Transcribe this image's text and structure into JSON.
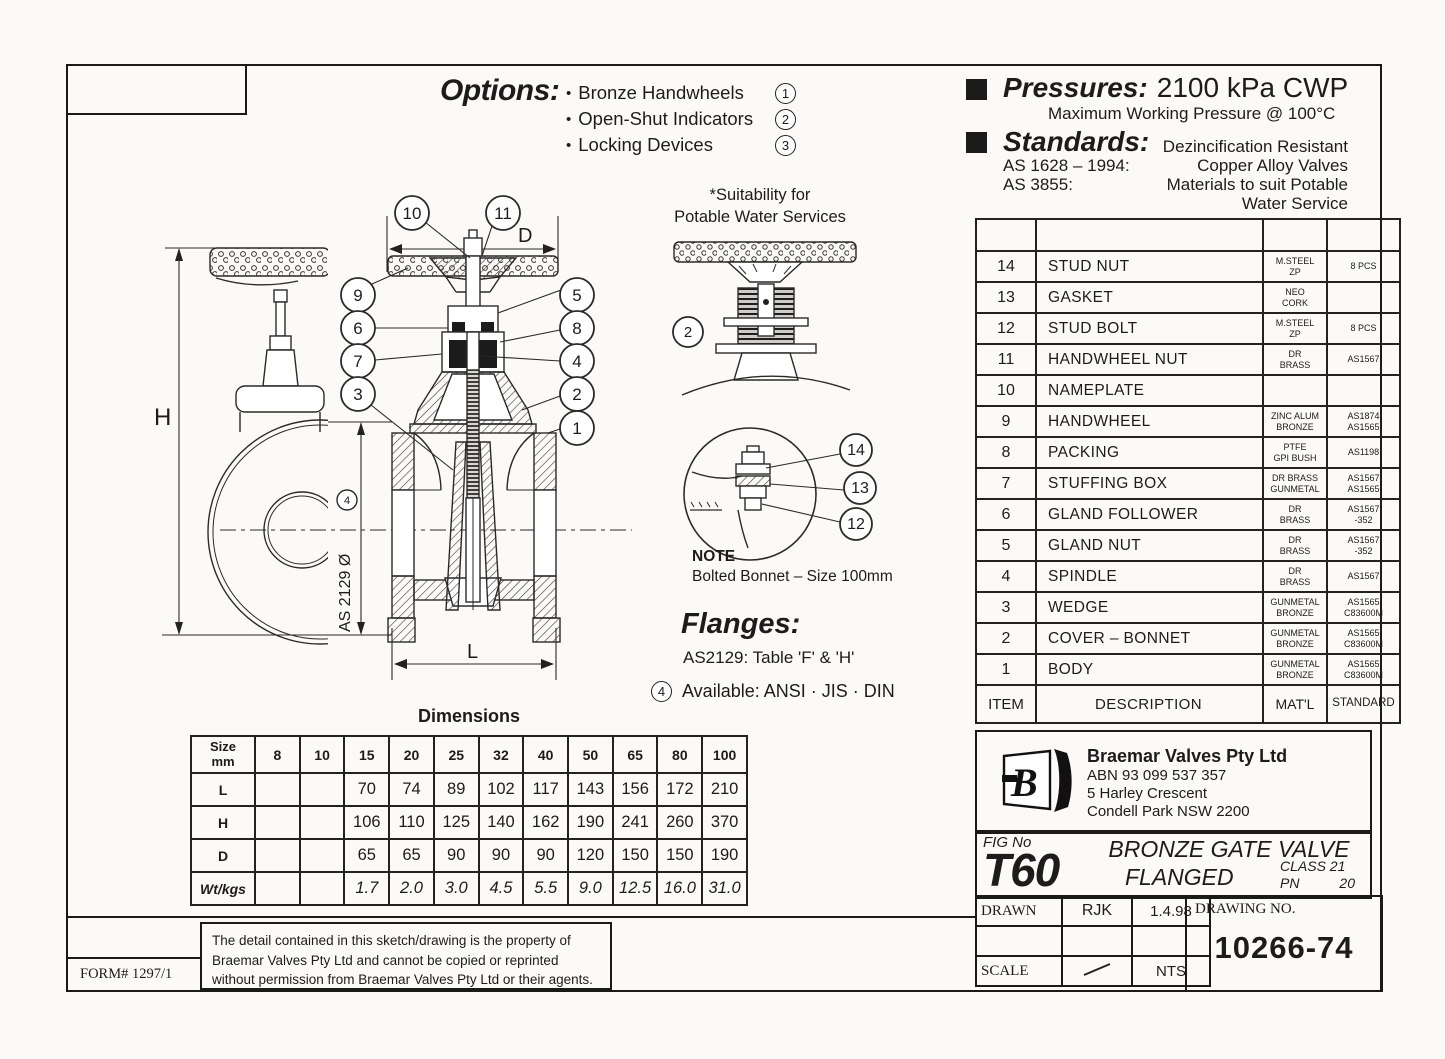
{
  "options": {
    "title": "Options:",
    "items": [
      {
        "label": "Bronze Handwheels",
        "num": "1"
      },
      {
        "label": "Open-Shut Indicators",
        "num": "2"
      },
      {
        "label": "Locking Devices",
        "num": "3"
      }
    ]
  },
  "pressures": {
    "title": "Pressures:",
    "value": "2100 kPa CWP",
    "subtitle": "Maximum Working Pressure @ 100°C"
  },
  "standards": {
    "title": "Standards:",
    "note": "Dezincification Resistant",
    "rows": [
      {
        "code": "AS 1628 – 1994:",
        "desc": "Copper Alloy Valves"
      },
      {
        "code": "AS 3855:",
        "desc": "Materials to suit Potable"
      }
    ],
    "desc_cont": "Water Service"
  },
  "suitability": {
    "line1": "*Suitability for",
    "line2": "Potable Water Services",
    "callout": "2"
  },
  "note": {
    "title": "NOTE",
    "text": "Bolted Bonnet – Size 100mm"
  },
  "flanges": {
    "title": "Flanges:",
    "text": "AS2129: Table 'F' & 'H'",
    "avail_num": "4",
    "avail": "Available: ANSI · JIS · DIN"
  },
  "drawing": {
    "dim_h": "H",
    "dim_d": "D",
    "dim_l": "L",
    "flange_label": "AS 2129 Ø",
    "flange_num": "4",
    "callouts": {
      "c1": "1",
      "c2": "2",
      "c3": "3",
      "c4": "4",
      "c5": "5",
      "c6": "6",
      "c7": "7",
      "c8": "8",
      "c9": "9",
      "c10": "10",
      "c11": "11"
    },
    "detail_callouts": {
      "c14": "14",
      "c13": "13",
      "c12": "12"
    }
  },
  "parts": {
    "rows": [
      {
        "item": "14",
        "desc": "STUD NUT",
        "matl": "M.STEEL\nZP",
        "std": "8 PCS"
      },
      {
        "item": "13",
        "desc": "GASKET",
        "matl": "NEO\nCORK",
        "std": ""
      },
      {
        "item": "12",
        "desc": "STUD BOLT",
        "matl": "M.STEEL\nZP",
        "std": "8 PCS"
      },
      {
        "item": "11",
        "desc": "HANDWHEEL NUT",
        "matl": "DR\nBRASS",
        "std": "AS1567"
      },
      {
        "item": "10",
        "desc": "NAMEPLATE",
        "matl": "",
        "std": ""
      },
      {
        "item": "9",
        "desc": "HANDWHEEL",
        "matl": "ZINC ALUM\nBRONZE",
        "std": "AS1874\nAS1565"
      },
      {
        "item": "8",
        "desc": "PACKING",
        "matl": "PTFE\nGPI BUSH",
        "std": "AS1198"
      },
      {
        "item": "7",
        "desc": "STUFFING BOX",
        "matl": "DR BRASS\nGUNMETAL",
        "std": "AS1567\nAS1565"
      },
      {
        "item": "6",
        "desc": "GLAND FOLLOWER",
        "matl": "DR\nBRASS",
        "std": "AS1567\n-352"
      },
      {
        "item": "5",
        "desc": "GLAND NUT",
        "matl": "DR\nBRASS",
        "std": "AS1567\n-352"
      },
      {
        "item": "4",
        "desc": "SPINDLE",
        "matl": "DR\nBRASS",
        "std": "AS1567"
      },
      {
        "item": "3",
        "desc": "WEDGE",
        "matl": "GUNMETAL\nBRONZE",
        "std": "AS1565\nC83600M"
      },
      {
        "item": "2",
        "desc": "COVER – BONNET",
        "matl": "GUNMETAL\nBRONZE",
        "std": "AS1565\nC83600M"
      },
      {
        "item": "1",
        "desc": "BODY",
        "matl": "GUNMETAL\nBRONZE",
        "std": "AS1565\nC83600M"
      }
    ],
    "footer": {
      "item": "ITEM",
      "desc": "DESCRIPTION",
      "matl": "MAT'L",
      "std": "STANDARD"
    }
  },
  "dims": {
    "title": "Dimensions",
    "corner": "Size\nmm",
    "sizes": [
      "8",
      "10",
      "15",
      "20",
      "25",
      "32",
      "40",
      "50",
      "65",
      "80",
      "100"
    ],
    "rows": [
      {
        "label": "L",
        "values": [
          "",
          "",
          "70",
          "74",
          "89",
          "102",
          "117",
          "143",
          "156",
          "172",
          "210"
        ]
      },
      {
        "label": "H",
        "values": [
          "",
          "",
          "106",
          "110",
          "125",
          "140",
          "162",
          "190",
          "241",
          "260",
          "370"
        ]
      },
      {
        "label": "D",
        "values": [
          "",
          "",
          "65",
          "65",
          "90",
          "90",
          "90",
          "120",
          "150",
          "150",
          "190"
        ]
      },
      {
        "label": "Wt/kgs",
        "values": [
          "",
          "",
          "1.7",
          "2.0",
          "3.0",
          "4.5",
          "5.5",
          "9.0",
          "12.5",
          "16.0",
          "31.0"
        ]
      }
    ]
  },
  "company": {
    "logo_letter": "B",
    "name": "Braemar Valves Pty Ltd",
    "abn": "ABN 93 099 537 357",
    "address1": "5 Harley Crescent",
    "address2": "Condell Park  NSW  2200"
  },
  "fig": {
    "label": "FIG No",
    "number": "T60",
    "product1": "BRONZE GATE VALVE",
    "product2": "FLANGED",
    "class_label": "CLASS 21",
    "pn_label": "PN",
    "pn_value": "20"
  },
  "titleblock": {
    "drawn_label": "DRAWN",
    "drawn_by": "RJK",
    "drawn_date": "1.4.98",
    "drawing_no_label": "DRAWING NO.",
    "drawing_no": "10266-74",
    "scale_label": "SCALE",
    "scale_value": "NTS"
  },
  "form": {
    "number": "FORM# 1297/1"
  },
  "disclaimer": "The detail contained in this sketch/drawing is the property of Braemar Valves Pty Ltd and cannot be copied or reprinted without permission from Braemar Valves Pty Ltd or their agents."
}
